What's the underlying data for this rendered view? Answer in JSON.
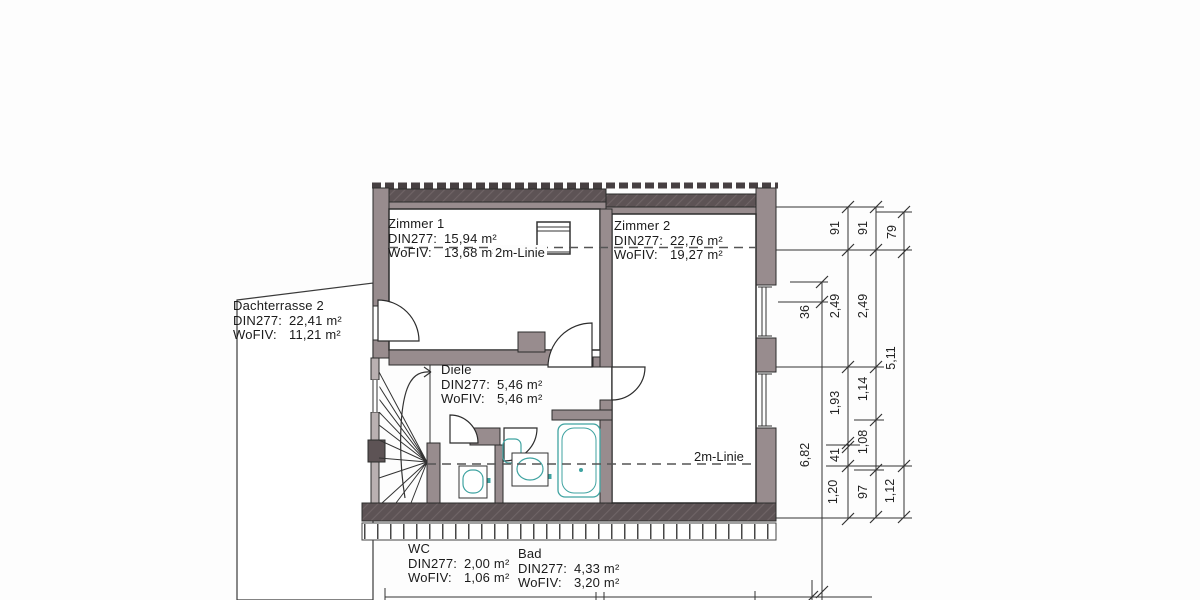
{
  "rooms": {
    "zimmer1": {
      "name": "Zimmer 1",
      "din_label": "DIN277:",
      "din_value": "15,94 m²",
      "wofiv_label": "WoFIV:",
      "wofiv_value": "13,68 m²"
    },
    "zimmer2": {
      "name": "Zimmer 2",
      "din_label": "DIN277:",
      "din_value": "22,76 m²",
      "wofiv_label": "WoFIV:",
      "wofiv_value": "19,27 m²"
    },
    "dachterrasse2": {
      "name": "Dachterrasse 2",
      "din_label": "DIN277:",
      "din_value": "22,41 m²",
      "wofiv_label": "WoFIV:",
      "wofiv_value": "11,21 m²"
    },
    "diele": {
      "name": "Diele",
      "din_label": "DIN277:",
      "din_value": "5,46 m²",
      "wofiv_label": "WoFIV:",
      "wofiv_value": "5,46 m²"
    },
    "wc": {
      "name": "WC",
      "din_label": "DIN277:",
      "din_value": "2,00 m²",
      "wofiv_label": "WoFIV:",
      "wofiv_value": "1,06 m²"
    },
    "bad": {
      "name": "Bad",
      "din_label": "DIN277:",
      "din_value": "4,33 m²",
      "wofiv_label": "WoFIV:",
      "wofiv_value": "3,20 m²"
    }
  },
  "annotations": {
    "linie_top": "2m-Linie",
    "linie_bottom": "2m-Linie"
  },
  "dimensions": {
    "chain_a": {
      "s1": "36",
      "s2": "6,82"
    },
    "chain_b": {
      "s1": "91",
      "s2": "2,49",
      "s3": "1,93",
      "s4": "41",
      "s5": "1,20"
    },
    "chain_c": {
      "s1": "91",
      "s2": "2,49",
      "s3": "1,14",
      "s4": "1,08",
      "s5": "97"
    },
    "chain_d": {
      "s1": "79",
      "s2": "5,11",
      "s3": "1,12"
    }
  },
  "colors": {
    "wall_medium": "#988c8e",
    "wall_dark": "#5d5355",
    "wall_light": "#b9b0b1",
    "fixture": "#3fa3a1",
    "line": "#2c2c2c",
    "dash": "#555555"
  }
}
